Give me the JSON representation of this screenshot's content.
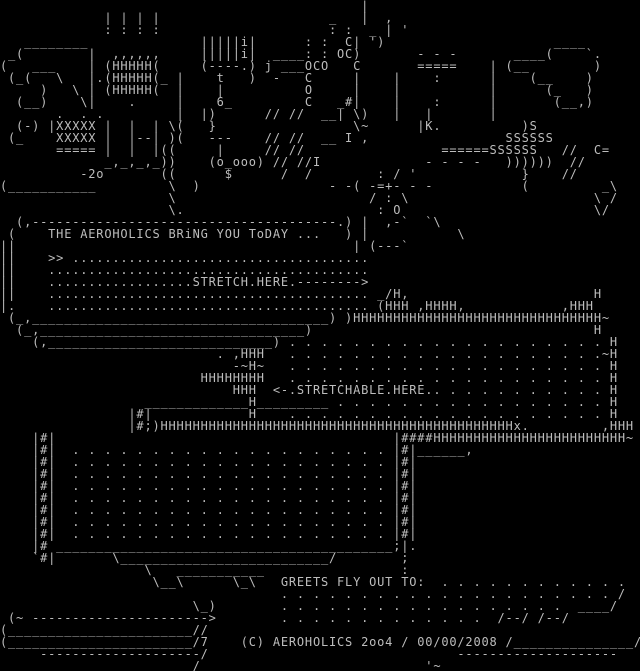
{
  "colors": {
    "background": "#000000",
    "foreground": "#bdbdbd"
  },
  "texts": {
    "intro_line": "THE AEROHOLICS BRiNG YOU ToDAY ...",
    "stretch_label": ".STRETCH.HERE.",
    "stretchable_label": "<-.STRETCHABLE.HERE.",
    "greets_label": "GREETS FLY OUT TO:",
    "copyright_line": "(C) AEROHOLICS 2oo4 / 00/00/2008"
  },
  "art": {
    "logo": "                                             |\n             | | | |                     _   |  ,\n             : : : :                     : :  _ | '\n   ________              |||||i|      : :  C| ')                     ____\n _(        |  ,,,,,,     |||||i|  ____: : OC)       - - -       ____(    `.\n(   ___    | (HHHHH(     (----.) j ___OCO   C       =====    | (__        )\n (_(   \\   |.(HHHHH(_ |    t   )  -   C     |    |    :      |    (__    )\n     )   \\ | (HHHHH(  |    |          O     |    |           |      (_   )\n  (__)    \\|    .     |    6_         C   _#|    |    :      |       (__,)\n       .  . .         |  |)      // //  __| \\)   |   |       |\n  (-) |XXXXX |  |  | \\(   }                 \\~      |K.          )S\n (_    XXXXX |  |--| )(   ---    // //  __ I ,                 SSSSSS\n       ===== |  |  |((     |     // //                 ======SSSSSS   //  C=\n             _,_,_,_))    (o_ooo) // //I             - - - -   ))))))  //\n          -2o       ((      $      /  /        : / '             }    //\n(___________         \\  )                - -( -=+- - -           (         _\\\n                     \\                        / : \\                       \\ /\n                     \\.                        : O                        \\/",
    "intro_box": "  (,--------------------------------------.) |  ,-`  `\\\n (    THE AEROHOLICS BRiNG YOU ToDAY ...   ) |           \\\n||                                          | (---`\n||    >> .....................................\n||    ........................................\n||    ..................STRETCH.HERE.-------->\n||    ........................................ _/H,                       H\n|.    ........................................ (HHH ,HHHH,            ,HHH\n (_,_____________________________________) )HHHHHHHHHHHHHHHHHHHHHHHHHHHHHHH~\n  (_,_________________________________)                                   H",
    "stretch_area": "    (,____________________________) . . . . . . . . . . . . . . . . . . . . H\n                           . ,HHH   . . . . . . . . . . . . . . . . . . . .~H\n                             -~H~   . . . . . . . . . . . . . . . . . . . . H\n                         HHHHHHHH   . . . . . . . . . . . . . . . . . . . . H\n                             HHH  <-.STRETCHABLE.HERE.. . . . . . . . . . . H\n                  _____________H_________ . . . . . . . . . . . . . . . . . H\n                |#|            H    . . . . . . . . . . . . . . . . . . . . H\n                |#;)HHHHHHHHHHHHHHHHHHHHHHHHHHHHHHHHHHHHHHHHHHHHx.         ,HHH",
    "block_area": "    |#|                                          |####HHHHHHHHHHHHHHHHHHHHHHHH~\n    |#|  . . . . . . . . . . . . . . . . . . . . |#|______,\n    |#|  . . . . . . . . . . . . . . . . . . . . |#|\n    |#|  . . . . . . . . . . . . . . . . . . . . |#|\n    |#|  . . . . . . . . . . . . . . . . . . . . |#|\n    |#|  . . . . . . . . . . . . . . . . . . . . |#|\n    |#|  . . . . . . . . . . . . . . . . . . . . |#|\n    |#|  . . . . . . . . . . . . . . . . . . . . |#|\n    |#|  . . . . . . . . . . . . . . . . . . . . |#|\n    |# __________________________________________;|.\n    `#|       \\__________________________/        ;\n                  \\   ___________                 :",
    "greets": "                   \\__\\      \\_\\   GREETS FLY OUT TO:  . . . . . . . . . . . .\n                                   . . . . . . . . . . . . . . . . . . . . . /\n                        \\_)        . . . . . . . . . . . . . . . . . .  ____/\n (~ ---------------------->        . . . . . . . . . . . . .  /--/ /--/",
    "footer": "(_______________________//\n(_______________________/7    (C) AEROHOLICS 2oo4 / 00/00/2008 /_______________/\n     --------------------/                               --------------------\n                       _/                            '~"
  }
}
